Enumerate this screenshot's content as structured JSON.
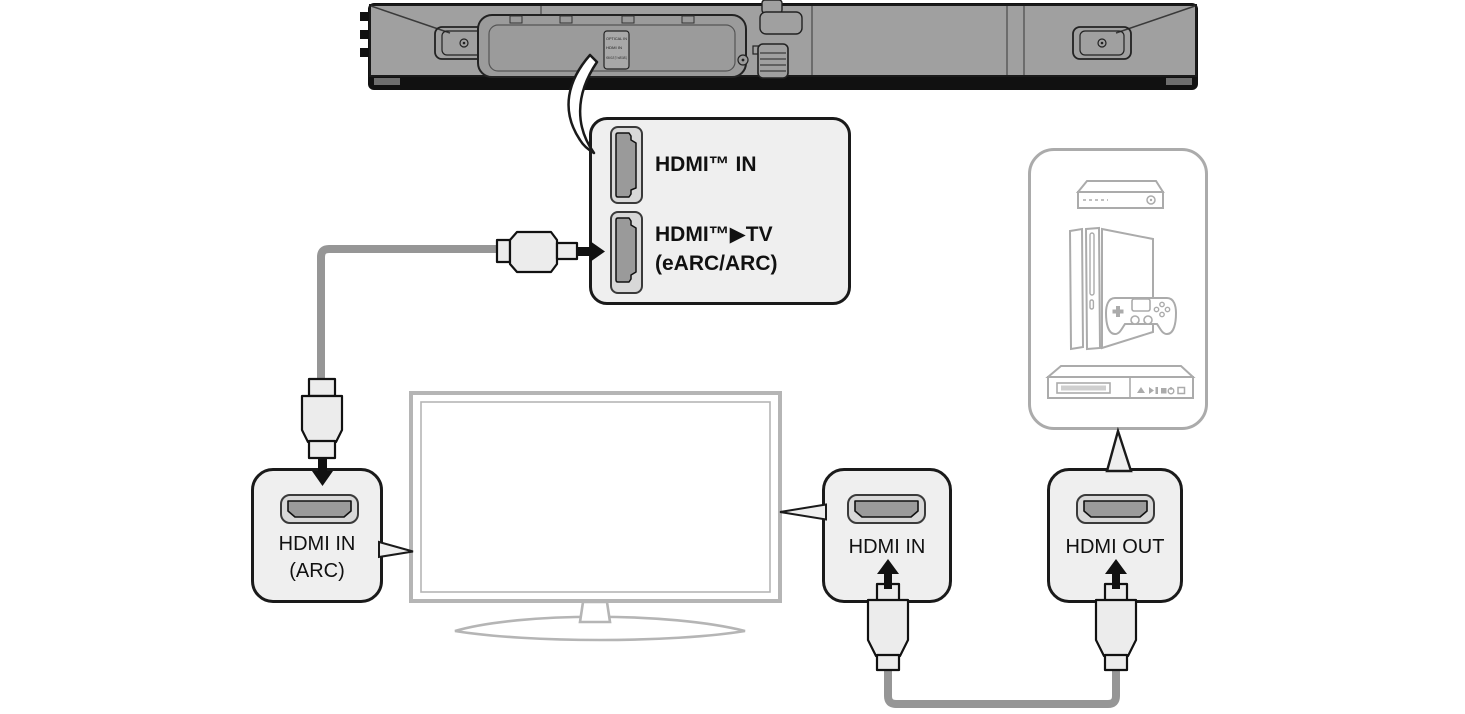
{
  "soundbar": {
    "plate_labels": [
      "OPTICAL IN",
      "HDMI IN",
      "HDMI OUT (TV eARC/ARC)"
    ]
  },
  "callout_panel": {
    "port1_label": "HDMI™ IN",
    "port2_label_line1": "HDMI™▶TV",
    "port2_label_line2": "(eARC/ARC)"
  },
  "tv": {
    "arc_port": {
      "line1": "HDMI IN",
      "line2": "(ARC)"
    },
    "hdmi_in_port": {
      "line1": "HDMI IN"
    }
  },
  "devices_panel": {
    "hdmi_out_port": {
      "line1": "HDMI OUT"
    },
    "icons": [
      "set-top-box-icon",
      "game-console-icon",
      "disc-player-icon"
    ]
  },
  "colors": {
    "outline": "#1a1a1a",
    "panel_fill": "#efefef",
    "soundbar_body": "#a0a0a0",
    "cable": "#969696",
    "plug_fill": "#ececec",
    "port_outer": "#d8d8d8",
    "port_inner": "#9a9a9a",
    "tv_outline": "#b5b5b5",
    "device_outline": "#ababab"
  }
}
